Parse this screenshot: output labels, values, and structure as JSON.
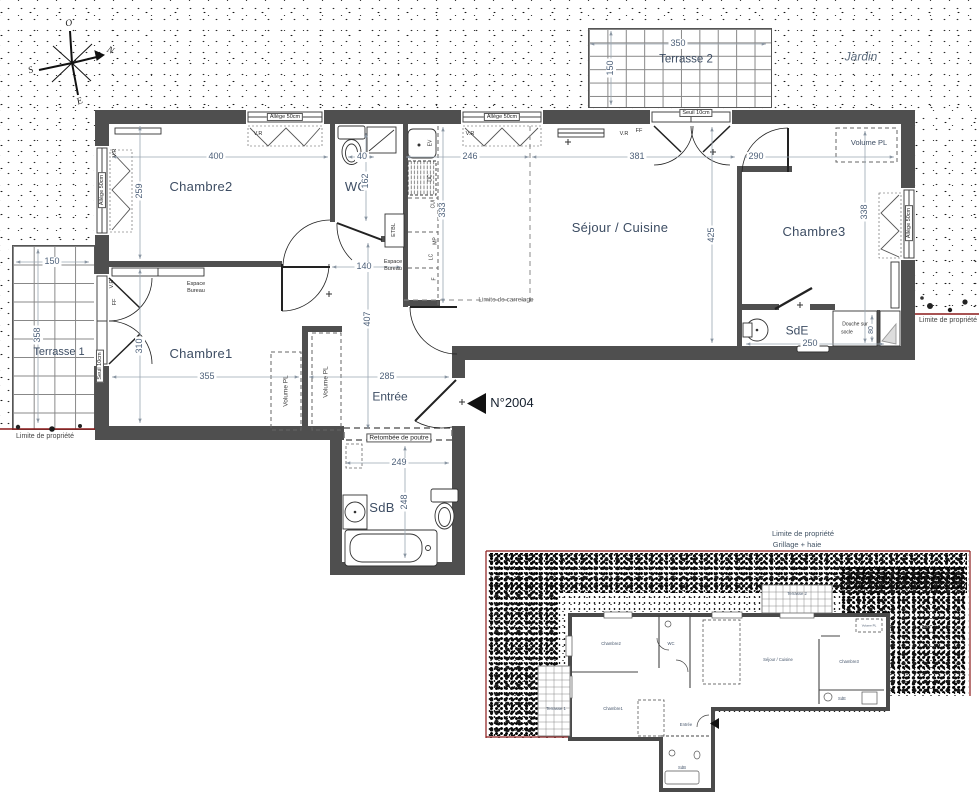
{
  "compass": {
    "west": "O",
    "north": "N",
    "south": "S",
    "east": "E"
  },
  "garden_label": "Jardin",
  "terrace2": {
    "name": "Terrasse 2",
    "width": "350",
    "height": "150"
  },
  "terrace1": {
    "name": "Terrasse 1",
    "width": "150",
    "height": "358"
  },
  "shared": {
    "allege": "Allège 50cm",
    "vr": "V.R",
    "ff": "FF",
    "seuil": "Seuil 10cm",
    "volume_pl": "Volume PL",
    "limite": "Limite de propriété",
    "espace_line1": "Espace",
    "espace_line2": "Bureau"
  },
  "rooms": {
    "chambre2": {
      "name": "Chambre2",
      "width": "400",
      "height": "259"
    },
    "wc": {
      "name": "WC",
      "width": "40",
      "height": "162"
    },
    "sejour": {
      "name": "Séjour / Cuisine",
      "dim_left": "246",
      "dim_right": "381",
      "depth_left": "333",
      "depth_right": "425",
      "carrelage": "Limite de carrelage"
    },
    "chambre3": {
      "name": "Chambre3",
      "width": "290",
      "height": "338"
    },
    "sde": {
      "name": "SdE",
      "width": "250",
      "shower_line1": "Douche sur",
      "shower_line2": "socle",
      "shower_width": "80"
    },
    "chambre1": {
      "name": "Chambre1",
      "width": "355",
      "height": "310"
    },
    "entree": {
      "name": "Entrée",
      "width": "285",
      "height": "407",
      "hall_width": "140",
      "beam": "Retombée de poutre"
    },
    "sdb": {
      "name": "SdB",
      "width": "249",
      "height": "248"
    }
  },
  "kitchen": {
    "sink": "EV",
    "fridge": "DC",
    "cui": "CUI",
    "mp": "MP",
    "lc": "LC",
    "f": "F",
    "etbl": "ETBL"
  },
  "unit_number": "N°2004",
  "site_plan": {
    "limite": "Limite de propriété",
    "fence": "Grillage + haie",
    "garden_dim": "400"
  },
  "colors": {
    "property_line": "#8b1a1a",
    "wall": "#4f4f4f",
    "label": "#3d4d63"
  }
}
